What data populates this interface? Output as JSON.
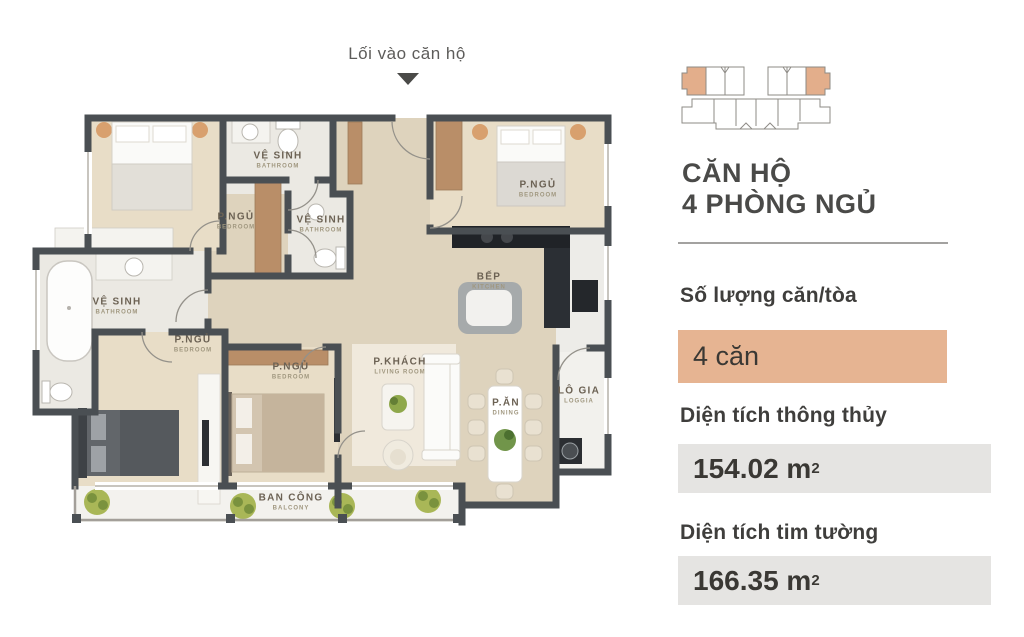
{
  "entrance": {
    "label": "Lối vào căn hộ"
  },
  "floor_plan": {
    "rooms": [
      {
        "id": "bathroom-top",
        "name": "VỆ SINH",
        "sub": "BATHROOM",
        "x": 278,
        "y": 160
      },
      {
        "id": "bedroom-top-left",
        "name": "P.NGỦ",
        "sub": "BEDROOM",
        "x": 236,
        "y": 221
      },
      {
        "id": "bathroom-middle",
        "name": "VỆ SINH",
        "sub": "BATHROOM",
        "x": 321,
        "y": 224
      },
      {
        "id": "bathroom-left",
        "name": "VỆ SINH",
        "sub": "BATHROOM",
        "x": 117,
        "y": 306
      },
      {
        "id": "bedroom-left",
        "name": "P.NGỦ",
        "sub": "BEDROOM",
        "x": 193,
        "y": 344
      },
      {
        "id": "bedroom-center",
        "name": "P.NGỦ",
        "sub": "BEDROOM",
        "x": 291,
        "y": 371
      },
      {
        "id": "bedroom-top-right",
        "name": "P.NGỦ",
        "sub": "BEDROOM",
        "x": 538,
        "y": 189
      },
      {
        "id": "kitchen",
        "name": "BẾP",
        "sub": "KITCHEN",
        "x": 489,
        "y": 281
      },
      {
        "id": "living-room",
        "name": "P.KHÁCH",
        "sub": "LIVING ROOM",
        "x": 400,
        "y": 366
      },
      {
        "id": "dining",
        "name": "P.ĂN",
        "sub": "DINING",
        "x": 506,
        "y": 407
      },
      {
        "id": "loggia",
        "name": "LÔ GIA",
        "sub": "LOGGIA",
        "x": 579,
        "y": 395
      },
      {
        "id": "balcony",
        "name": "BAN CÔNG",
        "sub": "BALCONY",
        "x": 291,
        "y": 502
      }
    ]
  },
  "info_panel": {
    "title_line1": "CĂN HỘ",
    "title_line2": "4 PHÒNG NGỦ",
    "units_label": "Số lượng căn/tòa",
    "units_value": "4 căn",
    "net_area_label": "Diện tích thông thủy",
    "net_area_value": "154.02 m",
    "net_area_sup": "2",
    "gross_area_label": "Diện tích tim tường",
    "gross_area_value": "166.35 m",
    "gross_area_sup": "2",
    "colors": {
      "accent_peach": "#e6b492",
      "value_gray": "#e5e4e2",
      "wall_dark": "#4a4f53",
      "wood": "#b98e68",
      "text_dark": "#3f3e3c"
    }
  }
}
